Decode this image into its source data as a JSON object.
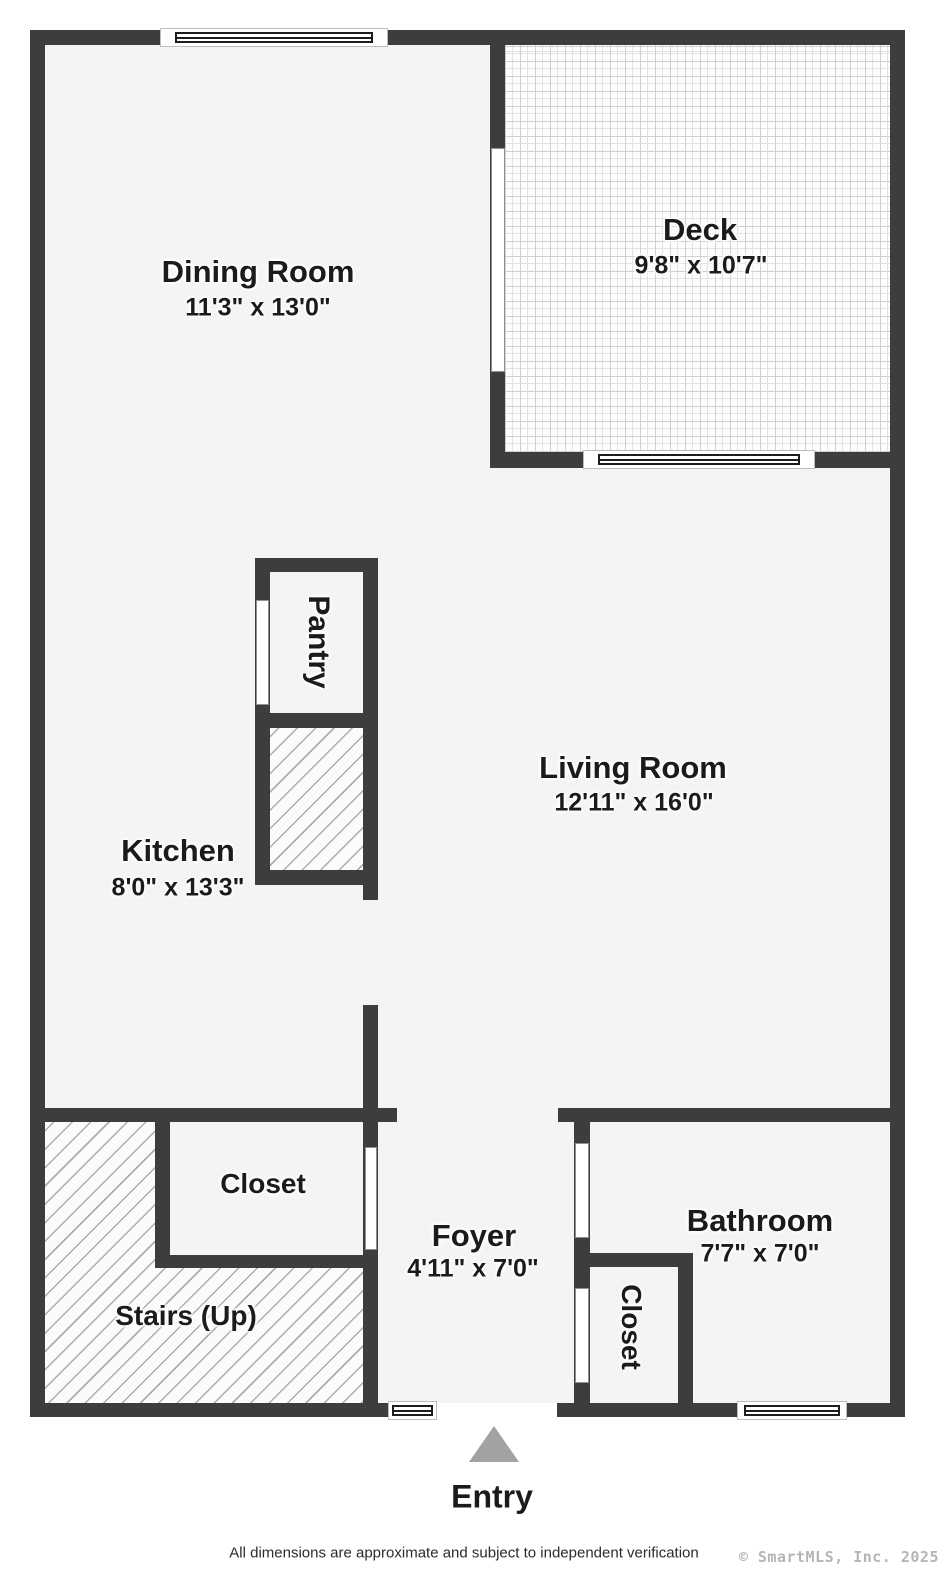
{
  "rooms": {
    "dining": {
      "name": "Dining Room",
      "dims": "11'3\" x 13'0\""
    },
    "deck": {
      "name": "Deck",
      "dims": "9'8\" x 10'7\""
    },
    "living": {
      "name": "Living Room",
      "dims": "12'11\" x 16'0\""
    },
    "kitchen": {
      "name": "Kitchen",
      "dims": "8'0\" x 13'3\""
    },
    "pantry": {
      "name": "Pantry"
    },
    "closet_hall": {
      "name": "Closet"
    },
    "foyer": {
      "name": "Foyer",
      "dims": "4'11\" x 7'0\""
    },
    "bathroom": {
      "name": "Bathroom",
      "dims": "7'7\" x 7'0\""
    },
    "closet_bath": {
      "name": "Closet"
    },
    "stairs": {
      "name": "Stairs (Up)"
    }
  },
  "entry": {
    "label": "Entry"
  },
  "footer": {
    "disclaimer": "All dimensions are approximate and subject to independent verification",
    "copyright": "© SmartMLS, Inc.  2025"
  },
  "colors": {
    "wall": "#3d3d3d",
    "floor": "#f4f4f5",
    "hatch_line": "#adadad",
    "deck_grid": "#cfcfcf",
    "entry_arrow": "#a2a2a2",
    "copyright_text": "#b5b5b5"
  }
}
